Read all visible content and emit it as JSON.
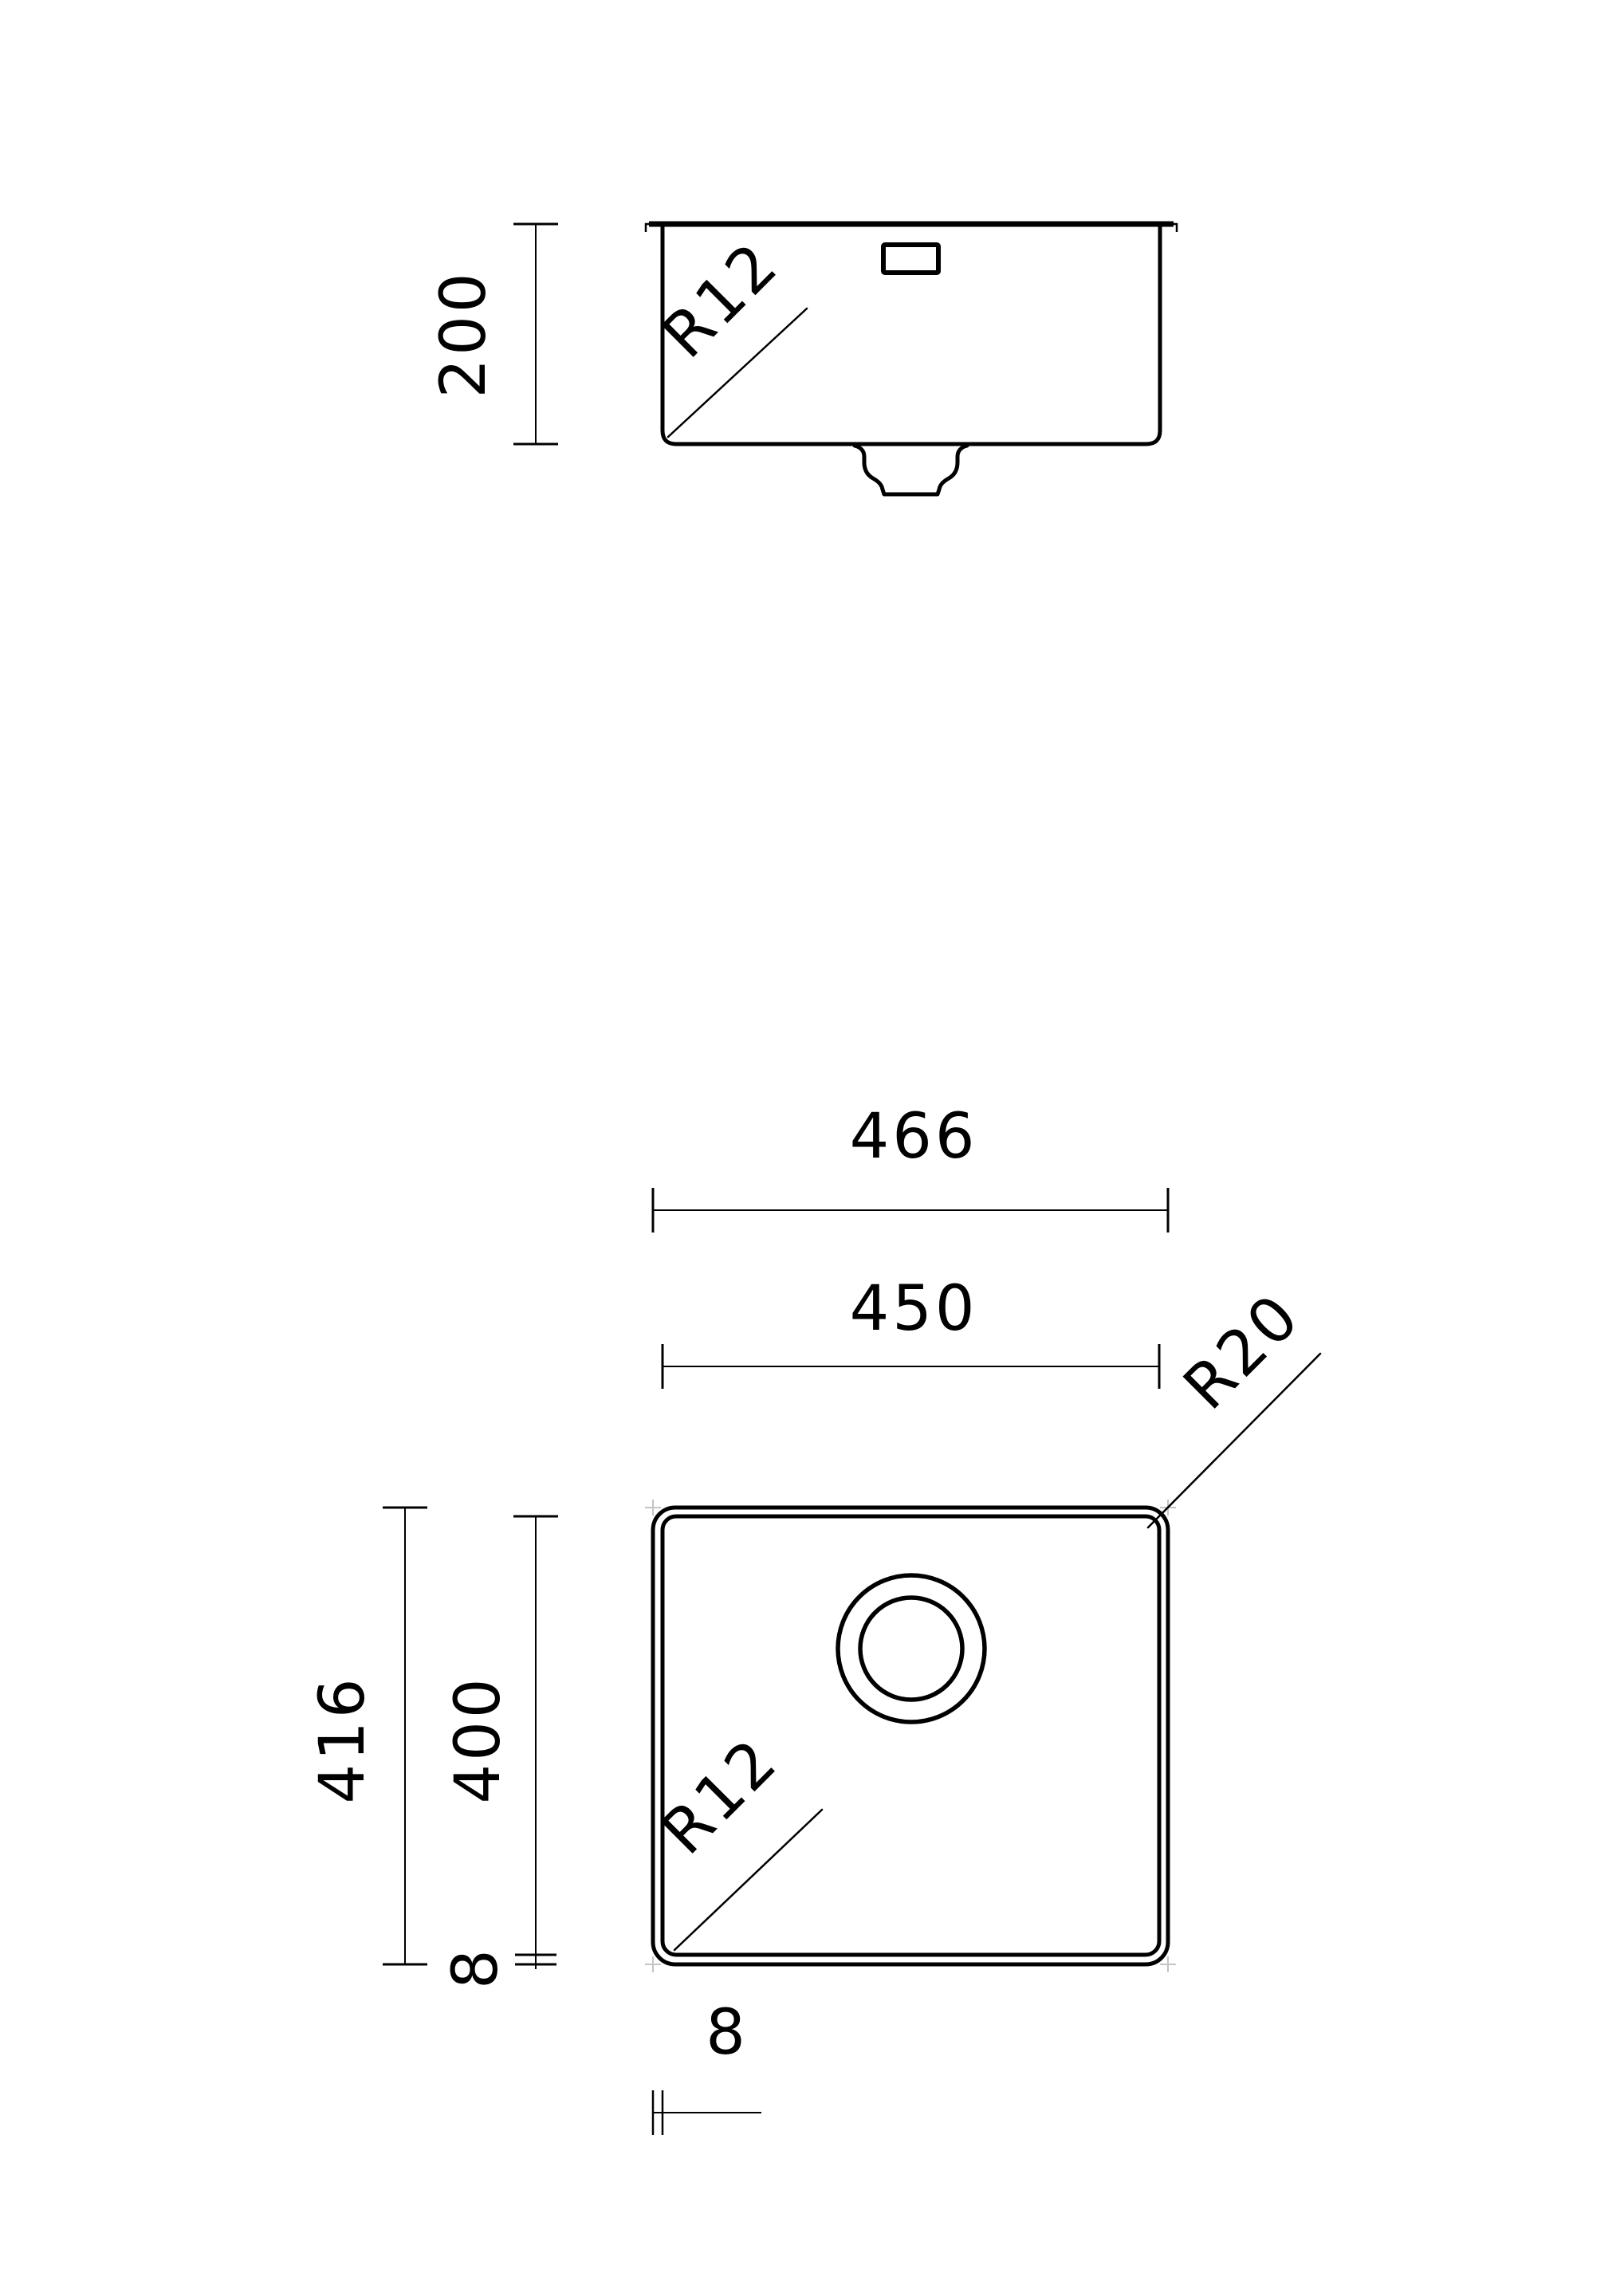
{
  "drawing": {
    "type": "technical-drawing-sink",
    "colors": {
      "line": "#000000",
      "background": "#ffffff",
      "corner_mark": "#c4c4c4"
    },
    "side_view": {
      "height_dim": "200",
      "corner_radius_label": "R12"
    },
    "plan_view": {
      "outer_width_dim": "466",
      "inner_width_dim": "450",
      "outer_height_dim": "416",
      "inner_height_dim": "400",
      "rim_side_dim": "8",
      "rim_bottom_dim": "8",
      "outer_corner_radius_label": "R20",
      "bowl_corner_radius_label": "R12"
    }
  }
}
